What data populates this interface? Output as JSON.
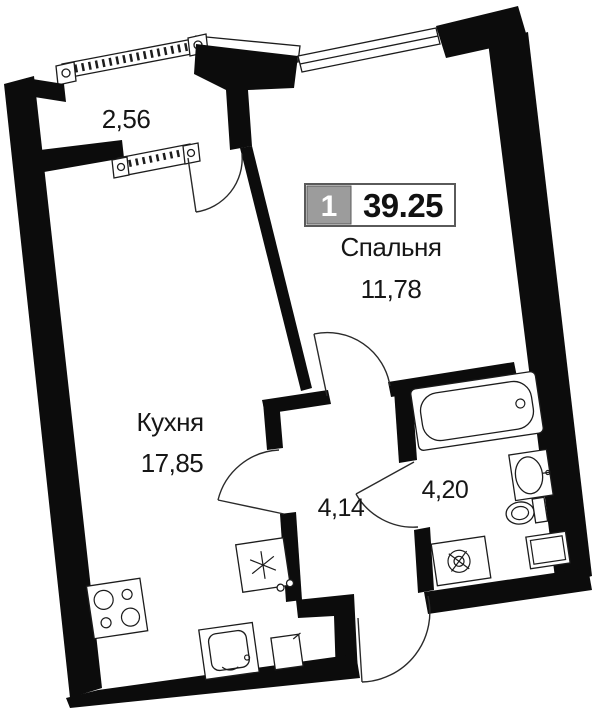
{
  "plan": {
    "title_badge": {
      "number": "1",
      "total_area": "39.25"
    },
    "rooms": [
      {
        "id": "bedroom",
        "name": "Спальня",
        "area": "11,78"
      },
      {
        "id": "kitchen",
        "name": "Кухня",
        "area": "17,85"
      },
      {
        "id": "hallway",
        "name": "",
        "area": "4,14"
      },
      {
        "id": "bathroom",
        "name": "",
        "area": "4,20"
      },
      {
        "id": "balcony",
        "name": "",
        "area": "2,56"
      }
    ],
    "fixtures": [
      "bathtub-icon",
      "sink-icon",
      "toilet-icon",
      "cabinet-icon",
      "washing-machine-icon",
      "fridge-icon",
      "stove-icon",
      "kitchen-sink-icon",
      "kitchen-cabinet-icon"
    ],
    "colors": {
      "wall": "#0c0c0c",
      "line": "#1c1c1c",
      "badge_gray": "#9c9c9c",
      "badge_border": "#5a5a5a",
      "text": "#161616",
      "background": "#ffffff"
    }
  }
}
